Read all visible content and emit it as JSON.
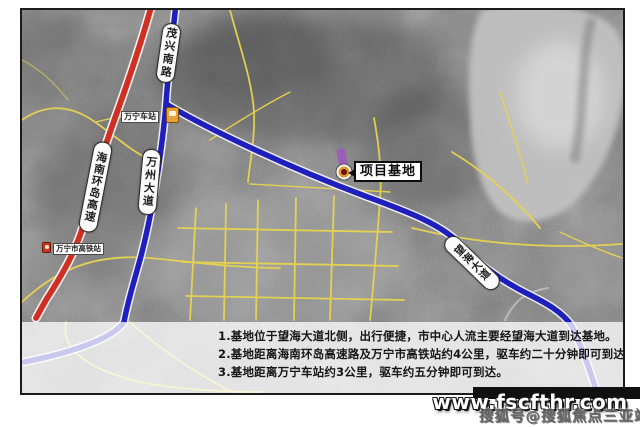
{
  "map": {
    "site_label": "项目基地",
    "road_labels": {
      "maoxing_south_road": "茂兴南路",
      "hainan_ring_expressway": "海南环岛高速",
      "wanzhou_avenue": "万州大道",
      "wanghai_avenue": "望海大道"
    },
    "stations": {
      "wanning_station": "万宁车站",
      "wanning_hsr_station": "万宁市高铁站"
    },
    "icons": {
      "site_marker": "target-marker-icon",
      "wanning_station_icon": "bus-station-icon",
      "hsr_station_icon": "rail-station-icon"
    },
    "colors": {
      "expressway_red": "#d03024",
      "road_blue": "#1f1fbe",
      "minor_road_yellow": "#e8d44f",
      "water_gray": "#c6c6c6",
      "station_icon_orange": "#e8a13a",
      "hsr_icon_red": "#c9381f",
      "site_highlight_purple": "#a04fc5",
      "marker_ring_orange": "#e09a28",
      "marker_center_red": "#6b0f0f"
    }
  },
  "caption": {
    "lines": [
      "1.基地位于望海大道北侧，出行便捷，市中心人流主要经望海大道到达基地。",
      "2.基地距离海南环岛高速路及万宁市高铁站约4公里，驱车约二十分钟即可到达。",
      "3.基地距离万宁车站约3公里，驱车约五分钟即可到达。"
    ]
  },
  "watermark": {
    "site_url": "www.fscfthr.com",
    "credit": "搜狐号@搜狐焦点三亚站"
  }
}
